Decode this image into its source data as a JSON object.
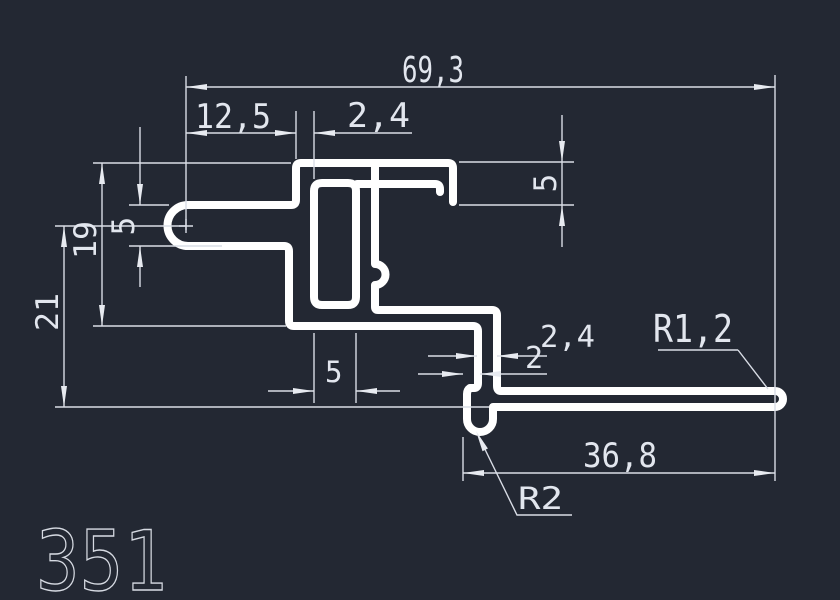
{
  "drawing": {
    "part_number": "351",
    "colors": {
      "background": "#232833",
      "profile_line": "#ffffff",
      "dimension_line": "#d9dde6",
      "dimension_text": "#e2e6ee"
    },
    "dimensions": {
      "overall_width": "69,3",
      "cap_offset": "12,5",
      "top_wall_thickness": "2,4",
      "right_lip_depth": "5",
      "left_arm_thickness": "5",
      "left_height_19": "19",
      "left_height_21": "21",
      "slot_width": "5",
      "lower_wall_thickness": "2,4",
      "lower_gap": "2",
      "end_radius": "R1,2",
      "arm_length": "36,8",
      "hook_radius": "R2"
    }
  }
}
